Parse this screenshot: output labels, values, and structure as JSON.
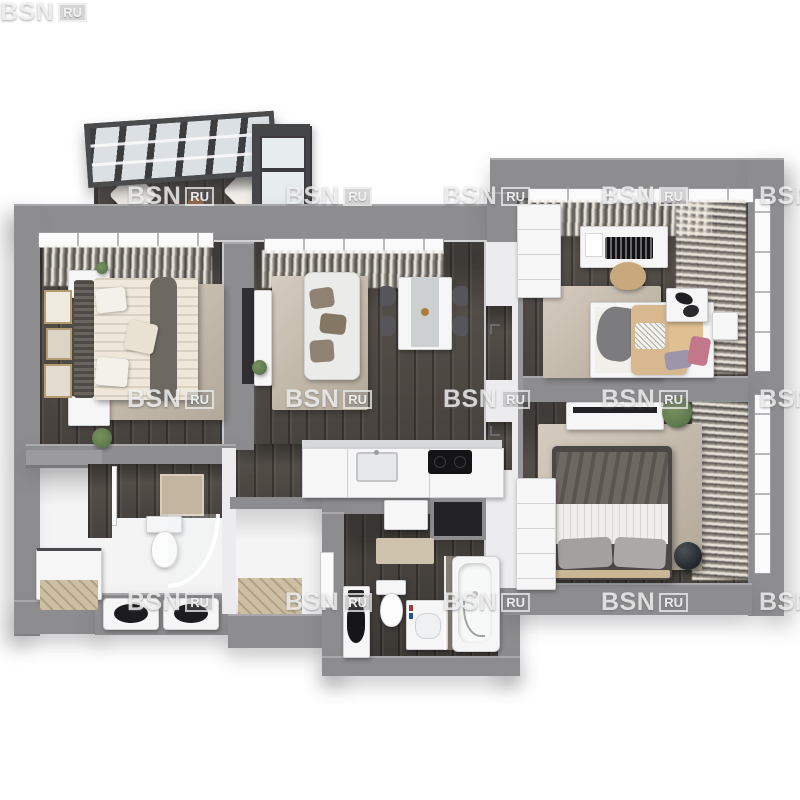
{
  "title": "3D apartment floor plan render",
  "watermark": {
    "brand": "BSN",
    "suffix": "RU",
    "columns": [
      127,
      285,
      443,
      601,
      759
    ],
    "rows": [
      184,
      387,
      590
    ]
  },
  "palette": {
    "wall": "#8d8d8f",
    "wall-dark": "#76767a",
    "inner-wall": "#ececee",
    "wood": "#57514b",
    "wood-light": "#cdbfa4",
    "floor-white": "#f4f4f5",
    "rug": "#c7bbaa",
    "glass": "#e7ecee",
    "frame-dark": "#3d3e40",
    "furniture-white": "#f6f6f7",
    "duvet-cream": "#efe8da",
    "throw-gray": "#6e6862",
    "tan": "#d8b88e",
    "pink": "#c2788a",
    "lilac": "#9d96ab",
    "plant-green": "#5f7a4f",
    "appliance-black": "#141416"
  }
}
